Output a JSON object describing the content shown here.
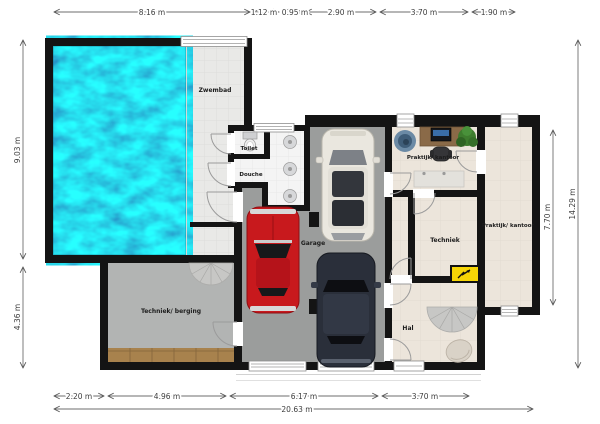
{
  "plan": {
    "rooms": {
      "zwembad": "Zwembad",
      "toilet": "Toilet",
      "douche": "Douche",
      "garage": "Garage",
      "praktijk_kantoor_1": "Praktijk/ kantoor",
      "techniek": "Techniek",
      "praktijk_kantoor_2": "Praktijk/ kantoor",
      "techniek_berging": "Techniek/ berging",
      "hal": "Hal"
    },
    "dimensions": {
      "top": [
        "8.16 m",
        "1.12 m",
        "0.95 m",
        "2.90 m",
        "3.70 m",
        "1.90 m"
      ],
      "bottom": [
        "2.20 m",
        "4.96 m",
        "6.17 m",
        "3.70 m"
      ],
      "bottom_total": "20.63 m",
      "left": [
        "9.03 m",
        "4.36 m"
      ],
      "right": [
        "7.70 m",
        "14.29 m"
      ]
    },
    "colors": {
      "wall": "#141414",
      "pool_water": "#1ba7dd",
      "pool_deck": "#e9e9e7",
      "garage_floor": "#9b9d9c",
      "storage_floor": "#b2b4b3",
      "office_floor": "#ece5db",
      "wet_room_floor": "#f4f4f4",
      "wood_strip": "#a8824d",
      "alert_panel": "#f6d506",
      "car_red": "#c8191d",
      "car_white": "#eae7df",
      "car_dark": "#2a2f3a"
    }
  }
}
